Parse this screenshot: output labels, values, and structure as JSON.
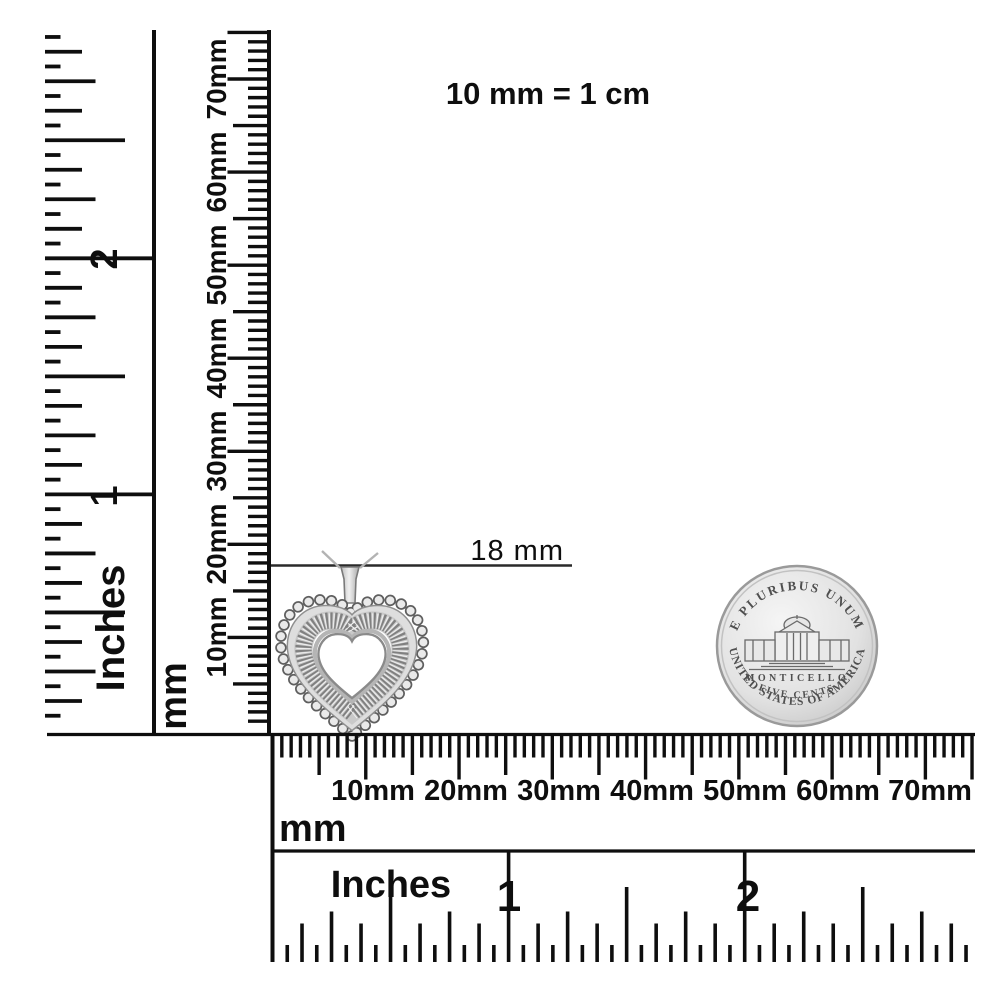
{
  "title": "10 mm = 1 cm",
  "annotation": {
    "label": "18 mm"
  },
  "rulers": {
    "left_inches": {
      "unit": "Inches",
      "numbers": [
        "1",
        "2"
      ]
    },
    "left_mm": {
      "unit": "mm",
      "labels": [
        "10mm",
        "20mm",
        "30mm",
        "40mm",
        "50mm",
        "60mm",
        "70mm"
      ]
    },
    "bottom_mm": {
      "unit": "mm",
      "labels": [
        "10mm",
        "20mm",
        "30mm",
        "40mm",
        "50mm",
        "60mm",
        "70mm"
      ]
    },
    "bottom_inches": {
      "unit": "Inches",
      "numbers": [
        "1",
        "2"
      ]
    }
  },
  "coin": {
    "top_text": "E PLURIBUS UNUM",
    "building": "MONTICELLO",
    "denomination": "FIVE CENTS",
    "bottom_text": "UNITED STATES OF AMERICA"
  },
  "colors": {
    "ink": "#0e0e0e",
    "silver_light": "#ececec",
    "silver_mid": "#d6d6d6",
    "silver_dark": "#8a8a8a"
  }
}
